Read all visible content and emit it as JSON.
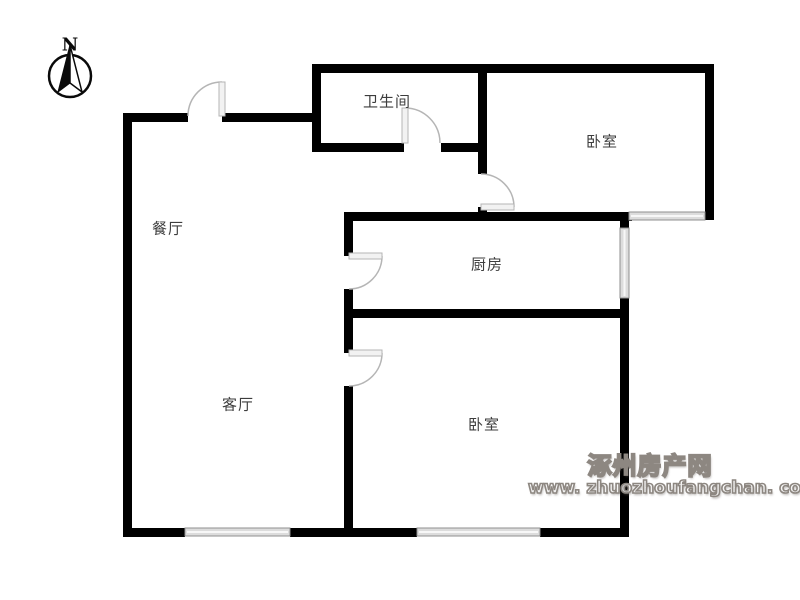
{
  "compass": {
    "label": "N"
  },
  "rooms": [
    {
      "id": "bathroom",
      "label": "卫生间"
    },
    {
      "id": "bedroom-top",
      "label": "卧室"
    },
    {
      "id": "dining-room",
      "label": "餐厅"
    },
    {
      "id": "kitchen",
      "label": "厨房"
    },
    {
      "id": "living-room",
      "label": "客厅"
    },
    {
      "id": "bedroom-bottom",
      "label": "卧室"
    }
  ],
  "watermark": {
    "line1": "涿州房产网",
    "line2": "www. zhuozhoufangchan. com"
  },
  "icons": [
    "north-compass-icon",
    "door-swing-icon",
    "window-icon"
  ],
  "colors": {
    "background": "#ffffff",
    "wall": "#000000",
    "window_fill": "#dcdcdc",
    "window_edge": "#8f8f8f",
    "door_line": "#b5b5b5",
    "door_panel_fill": "#f2f2f2",
    "label_text": "#3d3d3d",
    "watermark_gray": "#8d8781"
  }
}
